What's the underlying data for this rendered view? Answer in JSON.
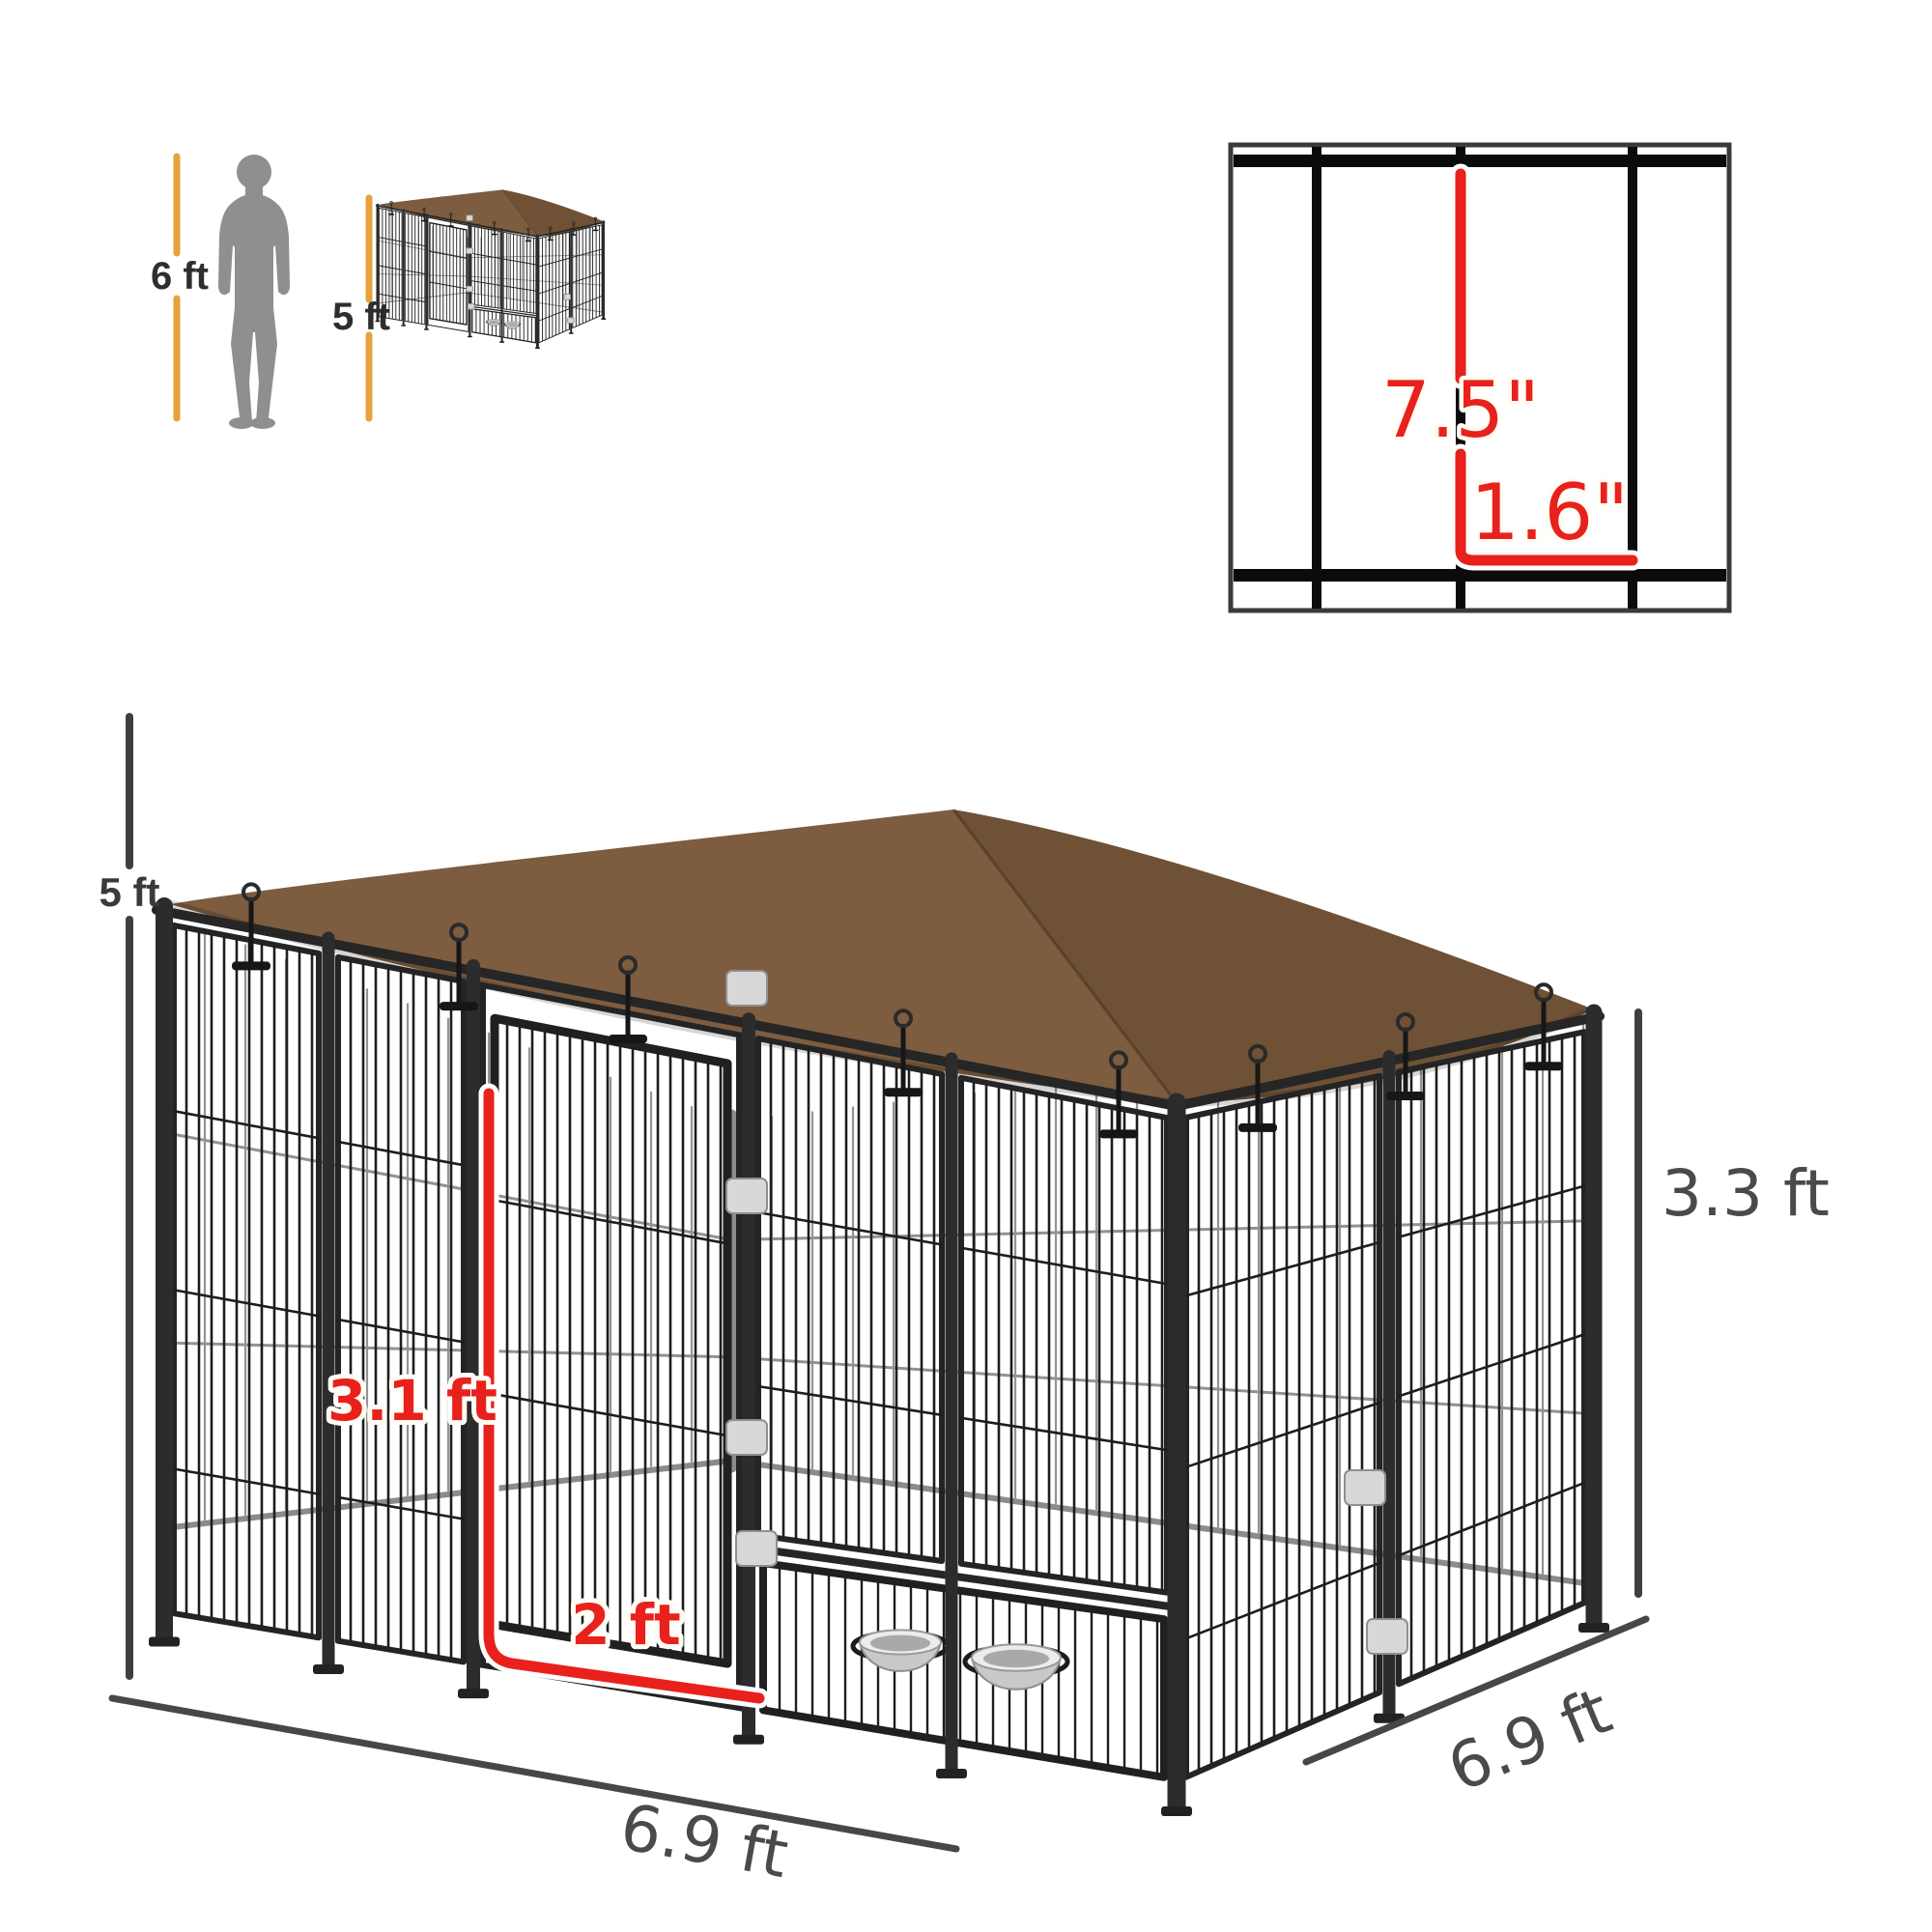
{
  "comparison": {
    "human_label": "6 ft",
    "kennel_label": "5 ft"
  },
  "detail": {
    "vertical_label": "7.5\"",
    "horizontal_label": "1.6\""
  },
  "dimensions": {
    "height": "5 ft",
    "door_height": "3.1 ft",
    "door_width": "2 ft",
    "front_width": "6.9 ft",
    "side_depth": "6.9 ft",
    "wall_height": "3.3 ft"
  },
  "colors": {
    "accent_red": "#e8211d",
    "accent_yellow": "#e7a23b",
    "dimension_gray": "#4a4a4a",
    "canopy_brown": "#7d5c40",
    "canopy_brown_dark": "#6f5136",
    "frame_black": "#262626",
    "wire_black": "#1d1d1d",
    "silhouette_gray": "#8f8f8f",
    "bowl_silver": "#c9c9c9"
  }
}
